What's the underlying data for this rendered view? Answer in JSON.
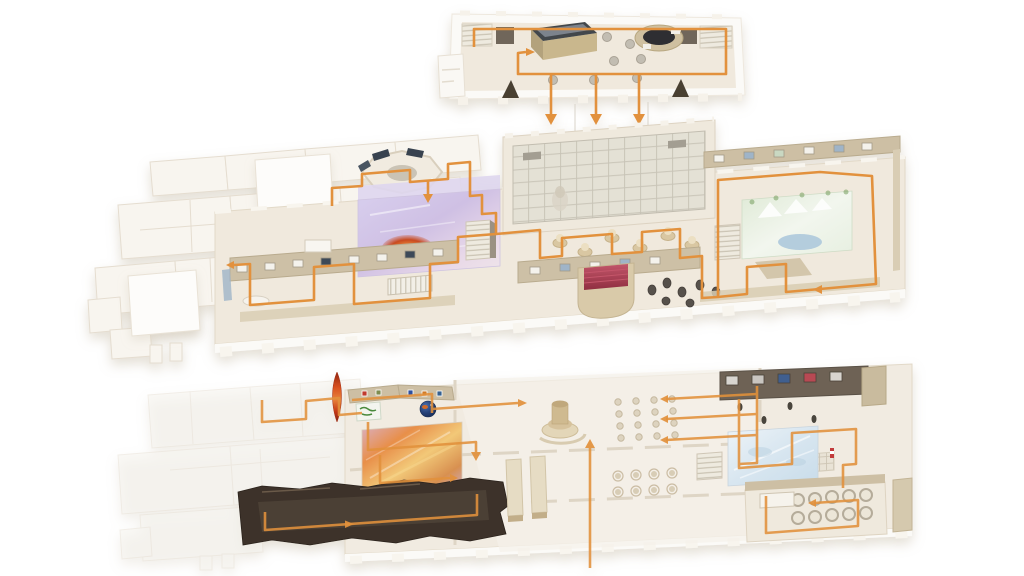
{
  "page": {
    "background": "#ffffff",
    "title": "Exploded isometric museum floor diagram with orange visitor route"
  },
  "colors": {
    "route": "#e2913c",
    "floor": "#f0e9dd",
    "floor_faded": "#f6f3ee",
    "slab_white": "#fbfaf7",
    "wall_tan": "#cdc0a6",
    "wall_dark": "#6e6254",
    "skylight": "#e6e3d8",
    "theater_red": "#a4384a",
    "cave_dark": "#3c3129",
    "tornado_red": "#c23616",
    "globe_blue": "#27437a",
    "mural_purple": "#cfc6e8",
    "mural_green": "#e4eedd",
    "mural_ice": "#d8e6f0",
    "lava_orange": "#e8953f",
    "crate_wood": "#c9b78d"
  },
  "floors": [
    {
      "id": "upper",
      "label": "Upper floor",
      "down_arrows": 3,
      "features": [
        "stairwell-left",
        "stairwell-right",
        "restroom-annex",
        "exhibit-crate",
        "round-drum-exhibit",
        "plinth-columns",
        "speaker-wedges",
        "route-loop"
      ]
    },
    {
      "id": "main",
      "label": "Main floor",
      "down_arrows": 0,
      "features": [
        "west-wing-rooms",
        "octagon-gallery",
        "volcano-mural-room",
        "skylight-atrium",
        "sculpture-gallery",
        "picture-display-walls",
        "red-theater",
        "statue-group",
        "landscape-mural-room",
        "staircases",
        "route-loop"
      ]
    },
    {
      "id": "lower",
      "label": "Lower floor",
      "down_arrows": 0,
      "features": [
        "west-wing-faded",
        "tornado-sculpture",
        "poster-wall",
        "globe-sphere",
        "floor-map-panel",
        "lava-mural-floor",
        "dark-cave-gallery",
        "central-fountain",
        "cafe-table-grid",
        "planter-benches",
        "entrance-axis-route",
        "ice-mural-room",
        "artifact-display-wall",
        "specimen-pod-room",
        "staircases",
        "route-loop"
      ]
    }
  ]
}
